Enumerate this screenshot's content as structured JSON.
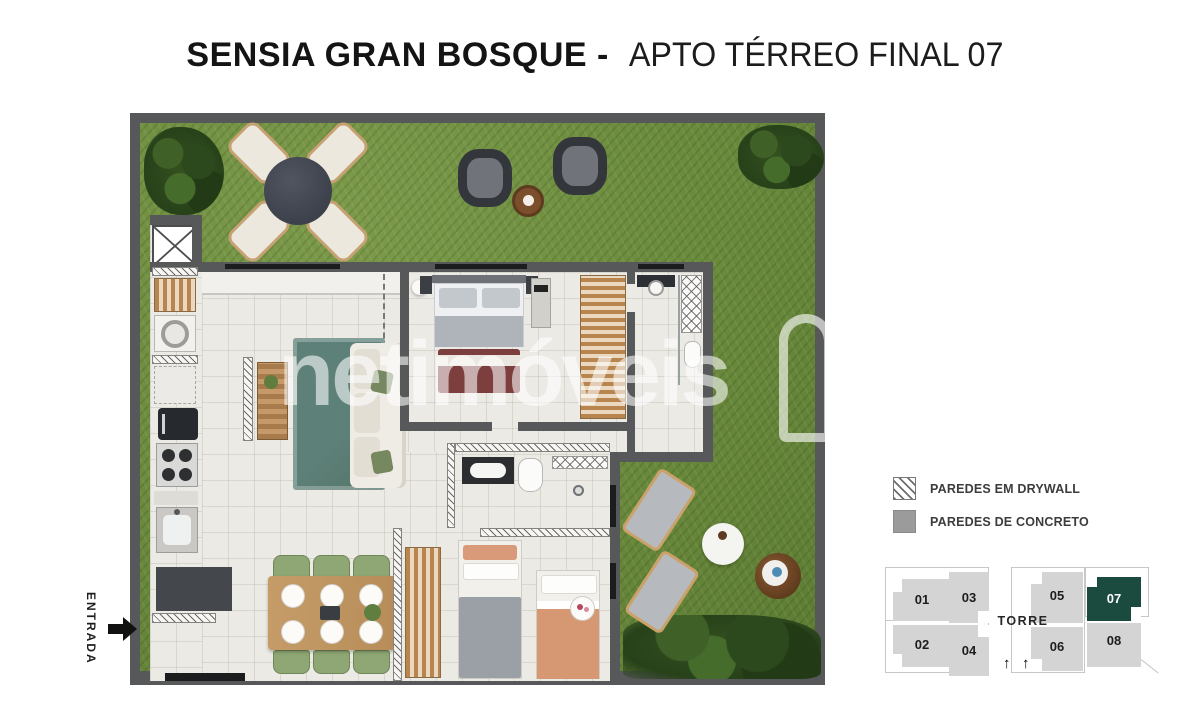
{
  "title": {
    "brand": "SENSIA GRAN BOSQUE -",
    "apartment": "APTO TÉRREO FINAL 07"
  },
  "entrance": {
    "label": "ENTRADA"
  },
  "watermark": {
    "text": "netimóveis"
  },
  "legend": {
    "items": [
      {
        "id": "drywall",
        "label": "PAREDES EM DRYWALL"
      },
      {
        "id": "concrete",
        "label": "PAREDES DE CONCRETO"
      }
    ]
  },
  "tower_map": {
    "title": "TORRE",
    "arrow": "↑",
    "highlight_unit": "07",
    "units": [
      {
        "number": "01"
      },
      {
        "number": "02"
      },
      {
        "number": "03"
      },
      {
        "number": "04"
      },
      {
        "number": "05"
      },
      {
        "number": "06"
      },
      {
        "number": "07"
      },
      {
        "number": "08"
      }
    ]
  },
  "colors": {
    "wall_concrete": "#57585a",
    "grass": "#6d8a3e",
    "tile_floor": "#eceae5",
    "highlight_unit": "#1b4a3f",
    "keyplan_unit": "#d4d4d4",
    "wood": "#bf9765",
    "rug": "#5d8078",
    "dining_chair": "#8ea774",
    "blanket_salmon": "#d69873"
  }
}
